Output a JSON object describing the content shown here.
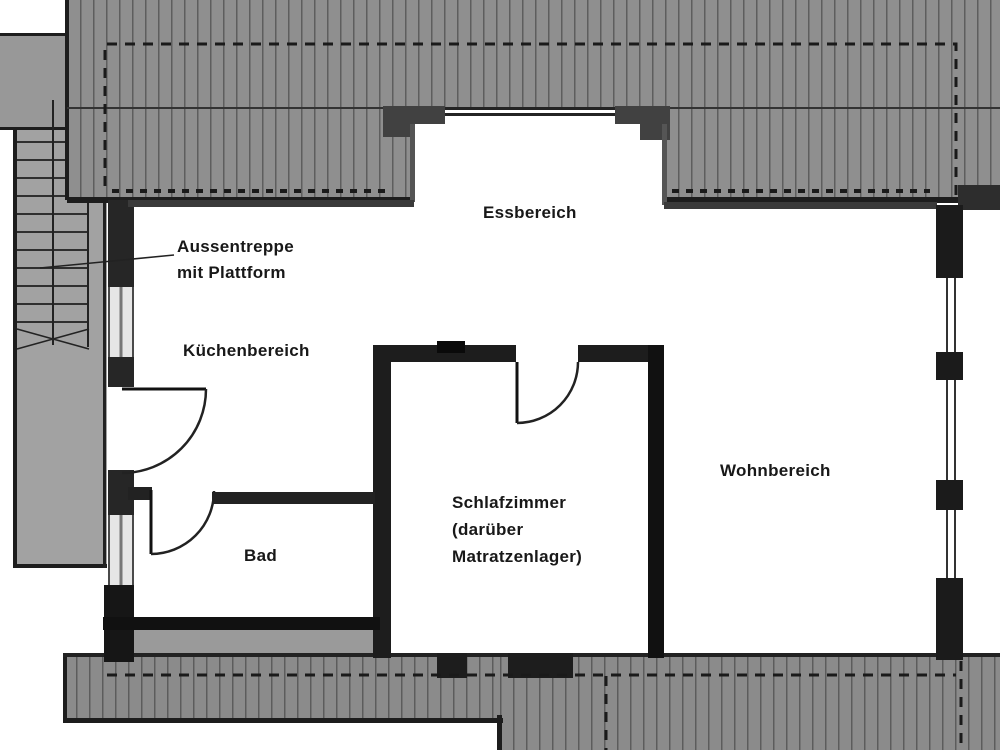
{
  "floorplan": {
    "rooms": [
      {
        "id": "essbereich",
        "label": "Essbereich"
      },
      {
        "id": "kuechenbereich",
        "label": "Küchenbereich"
      },
      {
        "id": "wohnbereich",
        "label": "Wohnbereich"
      },
      {
        "id": "schlafzimmer",
        "label": "Schlafzimmer",
        "sublabel_1": "(darüber",
        "sublabel_2": "Matratzenlager)"
      },
      {
        "id": "bad",
        "label": "Bad"
      }
    ],
    "annotations": [
      {
        "id": "aussentreppe",
        "line1": "Aussentreppe",
        "line2": "mit Plattform"
      }
    ],
    "colors": {
      "background": "#ffffff",
      "roof_fill": "#8f8f8f",
      "roof_hatch_line": "#5e5e5e",
      "wall_dark": "#1d1d1d",
      "wall_medium": "#3a3a3a",
      "stair_fill": "#a2a2a2",
      "neighbor_fill": "#989898",
      "window_light": "#e6e6e6",
      "line_color": "#111111"
    }
  }
}
